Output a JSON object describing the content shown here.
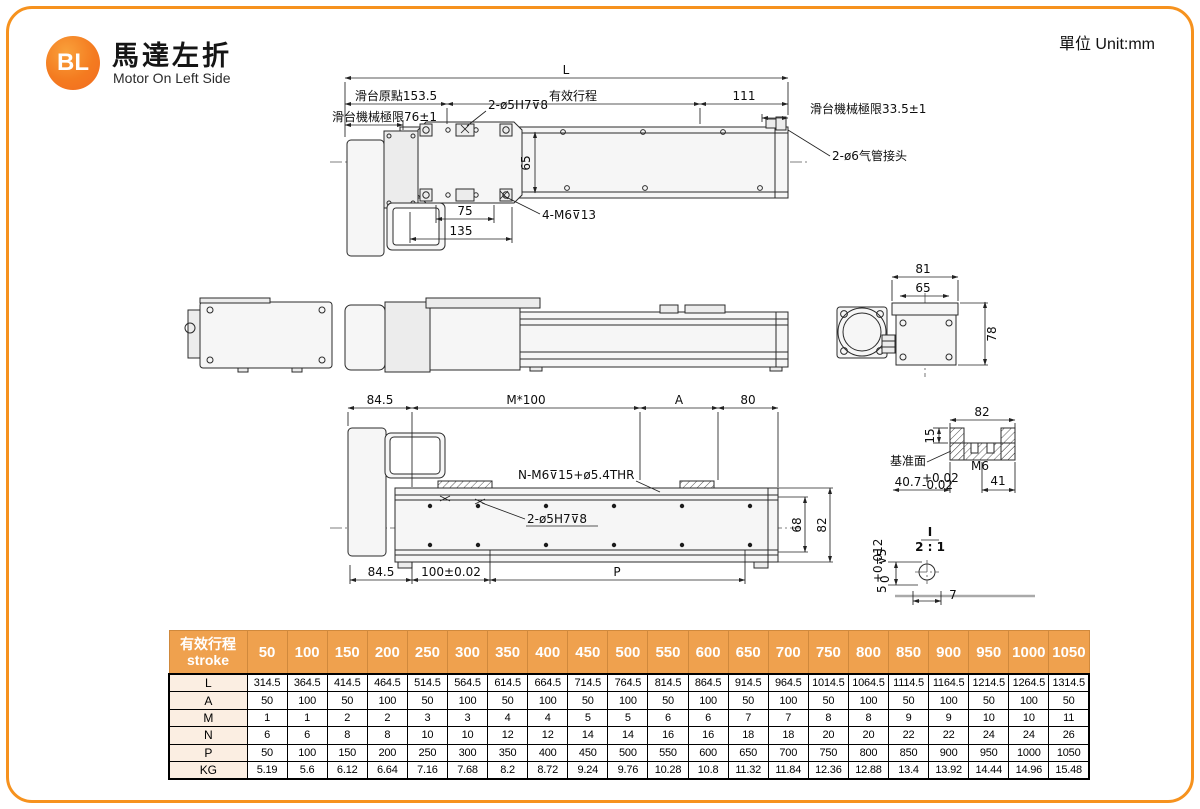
{
  "meta": {
    "unit_label": "單位 Unit:mm"
  },
  "colors": {
    "frame_orange": "#F6921E",
    "badge_orange": "#F47B20",
    "table_header_bg": "#EFA14E",
    "table_header_divider": "#D0893C",
    "row_label_bg": "#FBEEE2",
    "line_color": "#2B2B2B"
  },
  "header": {
    "badge": "BL",
    "title": "馬達左折",
    "subtitle": "Motor On Left Side"
  },
  "plan_view": {
    "dim_L": "L",
    "dim_origin": "滑台原點153.5",
    "dim_stroke": "有效行程",
    "dim_111": "111",
    "limit_left": "滑台機械極限76±1",
    "limit_right": "滑台機械極限33.5±1",
    "holes_label": "2-ø5H7⊽8",
    "m6_label": "4-M6⊽13",
    "fitting_label": "2-ø6气管接头",
    "dim_65": "65",
    "dim_75": "75",
    "dim_135": "135"
  },
  "end_view": {
    "dim_81": "81",
    "dim_65": "65",
    "dim_78": "78"
  },
  "side_view": {
    "dim_845_top": "84.5",
    "dim_pitch": "M*100",
    "dim_A": "A",
    "dim_80": "80",
    "thread_label": "N-M6⊽15+ø5.4THR",
    "holes_label": "2-ø5H7⊽8",
    "dim_68": "68",
    "dim_82": "82",
    "dim_845_bottom": "84.5",
    "dim_100": "100±0.02",
    "dim_P": "P"
  },
  "cross_section": {
    "dim_82": "82",
    "dim_15": "15",
    "datum_label": "基准面",
    "dim_M6": "M6",
    "dim_41": "41",
    "dim_407": "40.7",
    "tol_plus": "+0.02",
    "tol_minus": "-0.02"
  },
  "detail_view": {
    "label": "I",
    "scale": "2 : 1",
    "dim_5": "5",
    "tol_plus": "+0.012",
    "tol_zero": "0",
    "depth": "⊽5",
    "dim_7": "7"
  },
  "table": {
    "header_zh": "有效行程",
    "header_en": "stroke",
    "strokes": [
      "50",
      "100",
      "150",
      "200",
      "250",
      "300",
      "350",
      "400",
      "450",
      "500",
      "550",
      "600",
      "650",
      "700",
      "750",
      "800",
      "850",
      "900",
      "950",
      "1000",
      "1050"
    ],
    "rows": [
      {
        "label": "L",
        "values": [
          "314.5",
          "364.5",
          "414.5",
          "464.5",
          "514.5",
          "564.5",
          "614.5",
          "664.5",
          "714.5",
          "764.5",
          "814.5",
          "864.5",
          "914.5",
          "964.5",
          "1014.5",
          "1064.5",
          "1114.5",
          "1164.5",
          "1214.5",
          "1264.5",
          "1314.5"
        ]
      },
      {
        "label": "A",
        "values": [
          "50",
          "100",
          "50",
          "100",
          "50",
          "100",
          "50",
          "100",
          "50",
          "100",
          "50",
          "100",
          "50",
          "100",
          "50",
          "100",
          "50",
          "100",
          "50",
          "100",
          "50"
        ]
      },
      {
        "label": "M",
        "values": [
          "1",
          "1",
          "2",
          "2",
          "3",
          "3",
          "4",
          "4",
          "5",
          "5",
          "6",
          "6",
          "7",
          "7",
          "8",
          "8",
          "9",
          "9",
          "10",
          "10",
          "11"
        ]
      },
      {
        "label": "N",
        "values": [
          "6",
          "6",
          "8",
          "8",
          "10",
          "10",
          "12",
          "12",
          "14",
          "14",
          "16",
          "16",
          "18",
          "18",
          "20",
          "20",
          "22",
          "22",
          "24",
          "24",
          "26"
        ]
      },
      {
        "label": "P",
        "values": [
          "50",
          "100",
          "150",
          "200",
          "250",
          "300",
          "350",
          "400",
          "450",
          "500",
          "550",
          "600",
          "650",
          "700",
          "750",
          "800",
          "850",
          "900",
          "950",
          "1000",
          "1050"
        ]
      },
      {
        "label": "KG",
        "values": [
          "5.19",
          "5.6",
          "6.12",
          "6.64",
          "7.16",
          "7.68",
          "8.2",
          "8.72",
          "9.24",
          "9.76",
          "10.28",
          "10.8",
          "11.32",
          "11.84",
          "12.36",
          "12.88",
          "13.4",
          "13.92",
          "14.44",
          "14.96",
          "15.48"
        ]
      }
    ]
  }
}
